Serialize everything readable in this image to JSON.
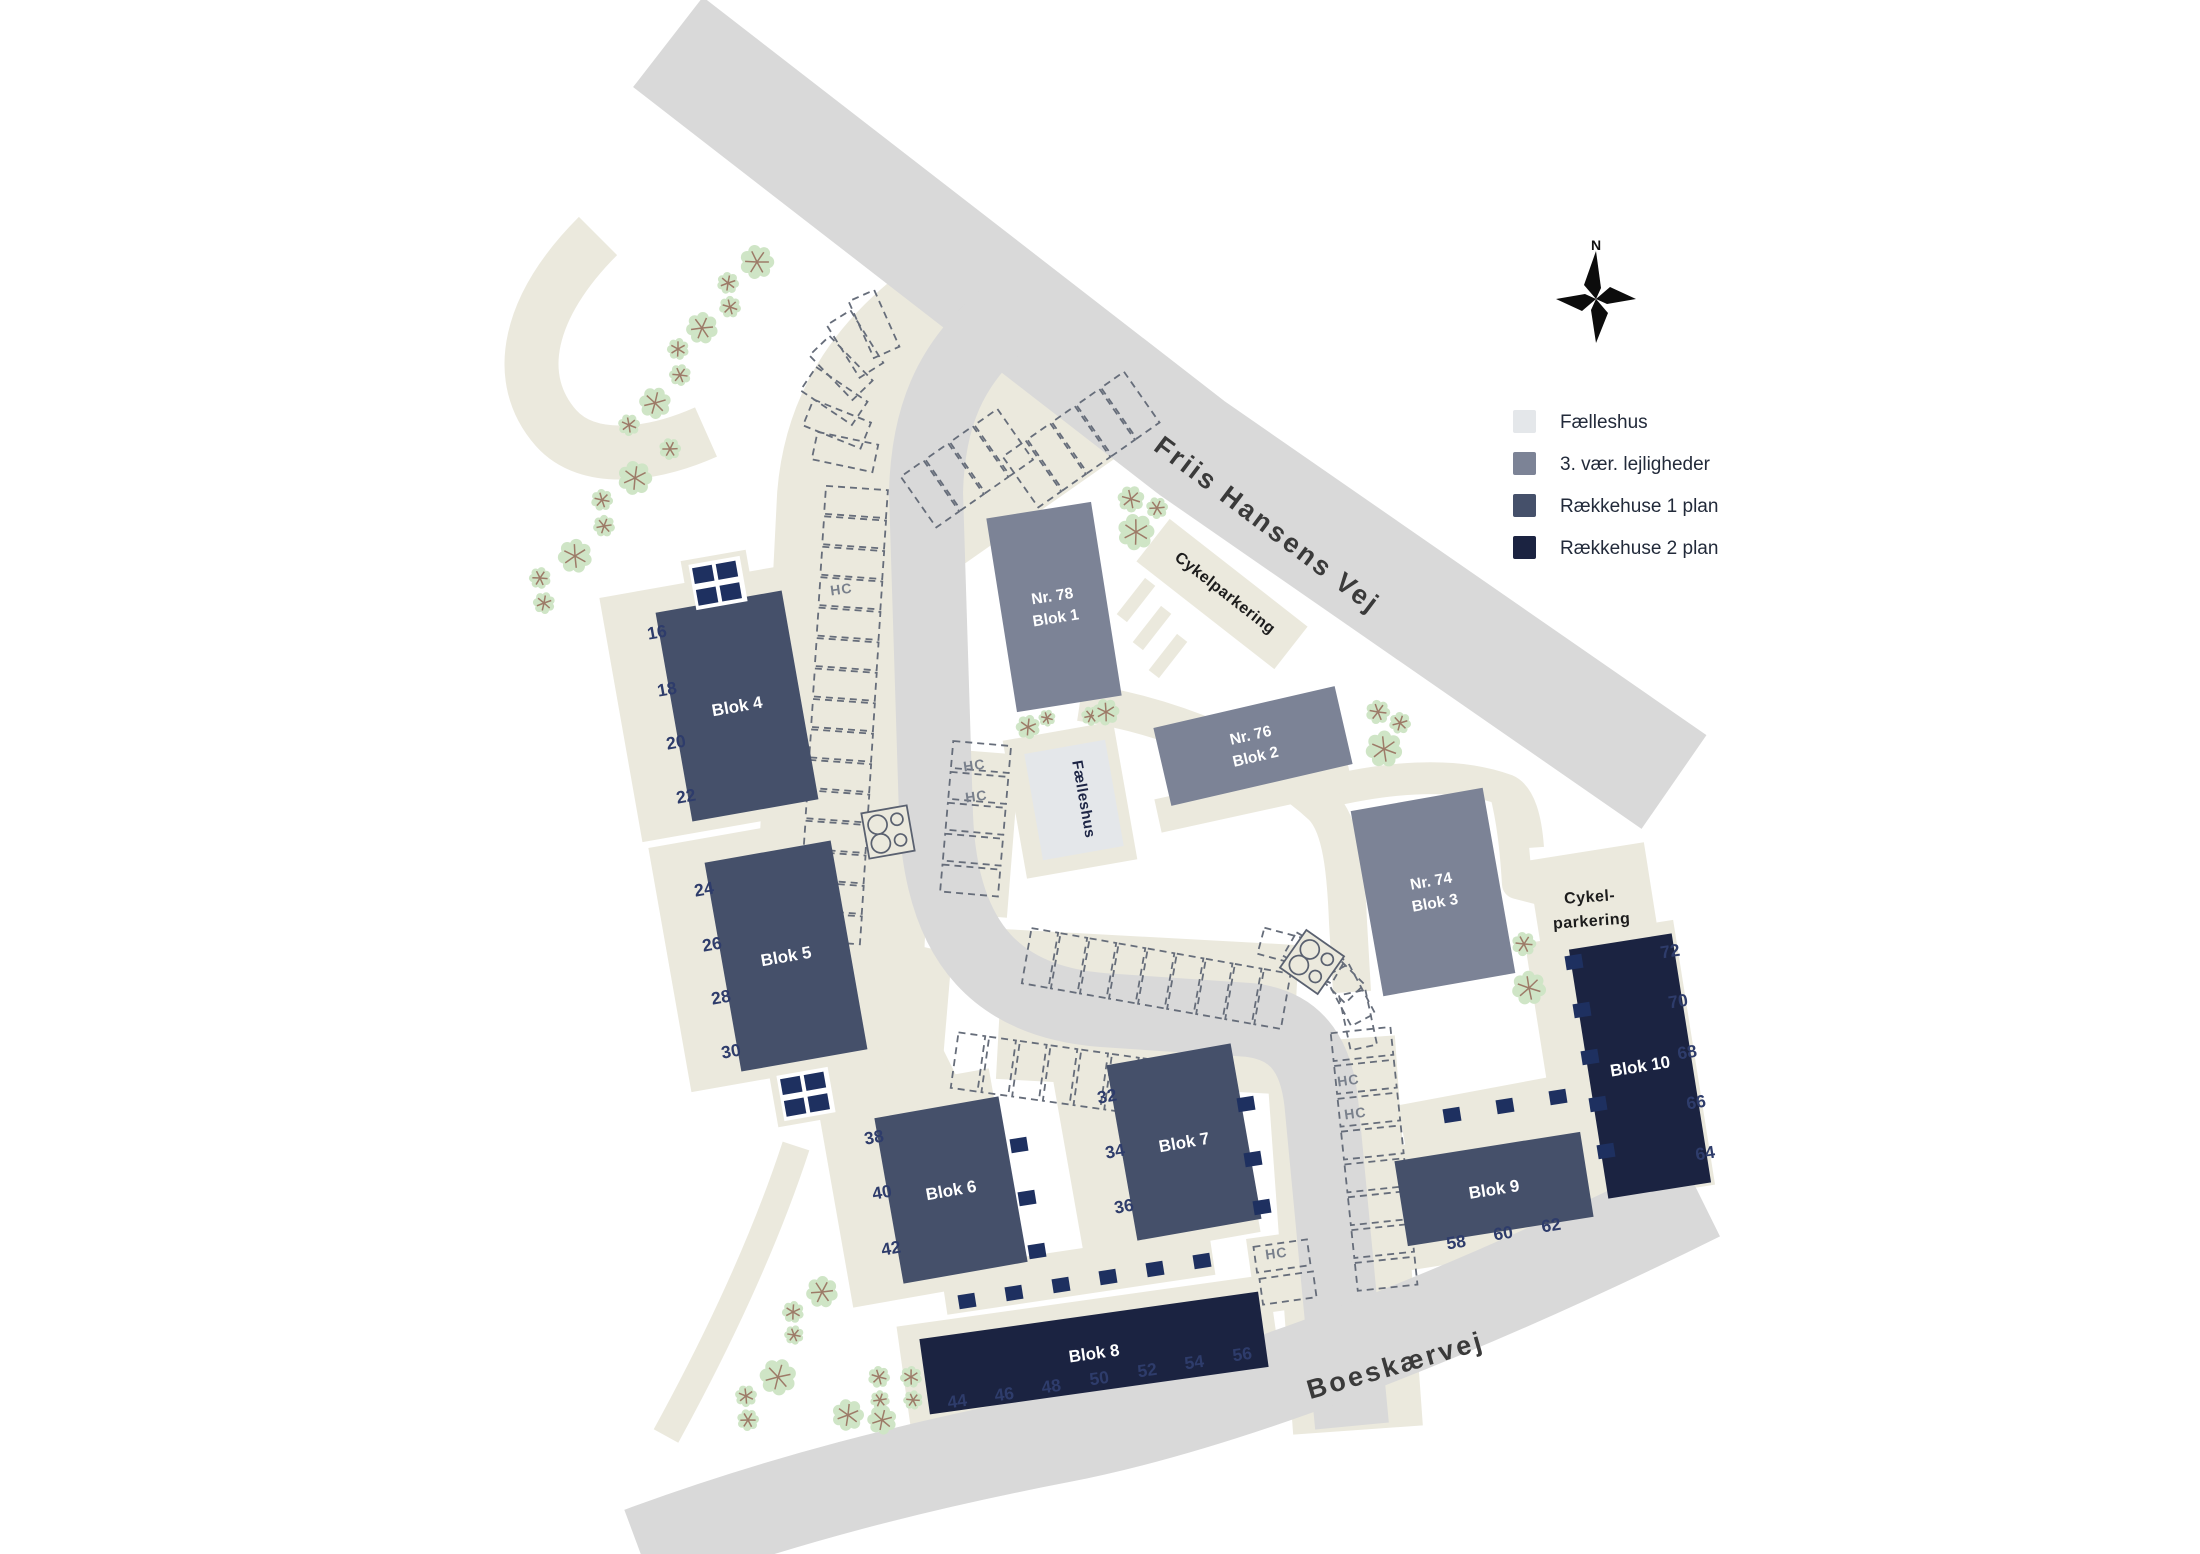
{
  "legend": {
    "items": [
      {
        "id": "faelleshus",
        "label": "Fælleshus",
        "color": "#e4e7ea"
      },
      {
        "id": "apartments",
        "label": "3. vær. lejligheder",
        "color": "#7c8396"
      },
      {
        "id": "rowhouse1",
        "label": "Rækkehuse 1 plan",
        "color": "#45506a"
      },
      {
        "id": "rowhouse2",
        "label": "Rækkehuse 2 plan",
        "color": "#1b2341"
      }
    ]
  },
  "compass": {
    "label": "N"
  },
  "streets": [
    {
      "id": "friis-hansens-vej",
      "name": "Friis Hansens Vej"
    },
    {
      "id": "boeskaervej",
      "name": "Boeskærvej"
    }
  ],
  "areas": [
    {
      "id": "cykelparkering-nord",
      "label": "Cykelparkering"
    },
    {
      "id": "cykelparkering-oest",
      "line1": "Cykel-",
      "line2": "parkering"
    }
  ],
  "faelleshus": {
    "building_label": "Fælleshus"
  },
  "hc_label": "HC",
  "category_colors": {
    "faelleshus": "#e4e7ea",
    "apartments": "#7c8396",
    "rowhouse1": "#45506a",
    "rowhouse2": "#1b2341"
  },
  "map_colors": {
    "road": "#d9d9d9",
    "path": "#ebe9dd",
    "tree_fill": "#cfe5c6",
    "tree_branch": "#9d7b68",
    "stall_stroke": "#666d7a",
    "shed_fill": "#1e3060"
  },
  "blocks": [
    {
      "id": "blok1",
      "lines": [
        "Nr. 78",
        "Blok 1"
      ],
      "category": "apartments",
      "units": []
    },
    {
      "id": "blok2",
      "lines": [
        "Nr. 76",
        "Blok 2"
      ],
      "category": "apartments",
      "units": []
    },
    {
      "id": "blok3",
      "lines": [
        "Nr. 74",
        "Blok 3"
      ],
      "category": "apartments",
      "units": []
    },
    {
      "id": "blok4",
      "lines": [
        "Blok 4"
      ],
      "category": "rowhouse1",
      "units": [
        "16",
        "18",
        "20",
        "22"
      ]
    },
    {
      "id": "blok5",
      "lines": [
        "Blok 5"
      ],
      "category": "rowhouse1",
      "units": [
        "24",
        "26",
        "28",
        "30"
      ]
    },
    {
      "id": "blok6",
      "lines": [
        "Blok 6"
      ],
      "category": "rowhouse1",
      "units": [
        "38",
        "40",
        "42"
      ]
    },
    {
      "id": "blok7",
      "lines": [
        "Blok 7"
      ],
      "category": "rowhouse1",
      "units": [
        "32",
        "34",
        "36"
      ]
    },
    {
      "id": "blok8",
      "lines": [
        "Blok 8"
      ],
      "category": "rowhouse2",
      "units": [
        "44",
        "46",
        "48",
        "50",
        "52",
        "54",
        "56"
      ]
    },
    {
      "id": "blok9",
      "lines": [
        "Blok 9"
      ],
      "category": "rowhouse1",
      "units": [
        "58",
        "60",
        "62"
      ]
    },
    {
      "id": "blok10",
      "lines": [
        "Blok 10"
      ],
      "category": "rowhouse2",
      "units": [
        "72",
        "70",
        "68",
        "66",
        "64"
      ]
    }
  ]
}
